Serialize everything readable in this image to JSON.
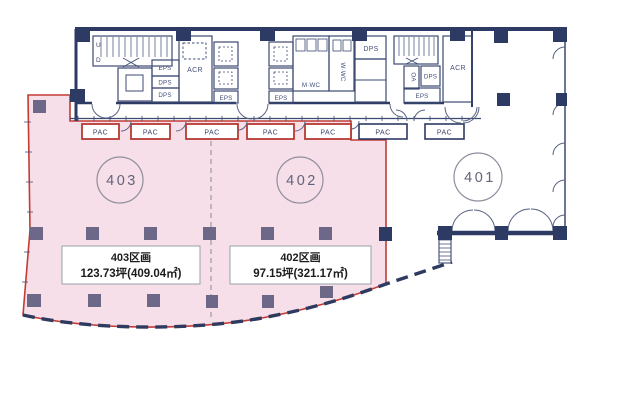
{
  "document_type": "floor-plan",
  "units": {
    "u403": {
      "number": "403",
      "parcel_title": "403区画",
      "parcel_area": "123.73坪(409.04㎡)"
    },
    "u402": {
      "number": "402",
      "parcel_title": "402区画",
      "parcel_area": "97.15坪(321.17㎡)"
    },
    "u401": {
      "number": "401"
    }
  },
  "labels": {
    "pac": "PAC",
    "eps": "EPS",
    "dps": "DPS",
    "acr": "ACR",
    "oa": "OA",
    "mens_wc": "M·WC",
    "womens_wc": "W·WC",
    "stair_up": "U",
    "stair_down": "D"
  },
  "colors": {
    "wall_navy": "#2d3a63",
    "leased_fill": "#f6dfe9",
    "leased_border": "#c23b35",
    "column_muted": "#6e6888",
    "circle_stroke": "#8f8d9c",
    "infobox_border": "#9aa0a8"
  }
}
